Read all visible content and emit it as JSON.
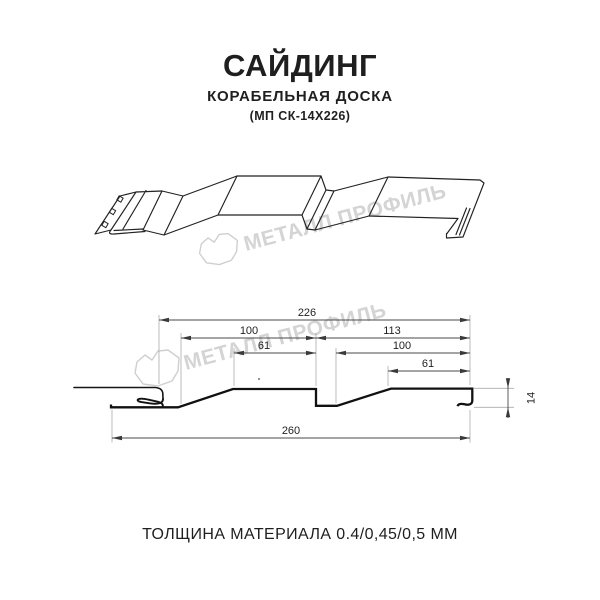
{
  "header": {
    "title": "САЙДИНГ",
    "subtitle": "КОРАБЕЛЬНАЯ ДОСКА",
    "model": "(МП СК-14Х226)"
  },
  "watermark": {
    "text": "МЕТАЛЛ ПРОФИЛЬ"
  },
  "section_dimensions": {
    "overall_width": "226",
    "board1_width": "100",
    "board2_span": "113",
    "board1_top": "61",
    "board2_width": "100",
    "board2_top": "61",
    "profile_height": "14",
    "total_width": "260"
  },
  "footer": {
    "thickness": "ТОЛЩИНА МАТЕРИАЛА 0.4/0,45/0,5 ММ"
  },
  "colors": {
    "line_art": "#1f1f1f",
    "dimension_lines": "#4a4a4a",
    "extension_lines": "#ababab",
    "watermark": "#d4d4d4",
    "background": "#ffffff"
  }
}
